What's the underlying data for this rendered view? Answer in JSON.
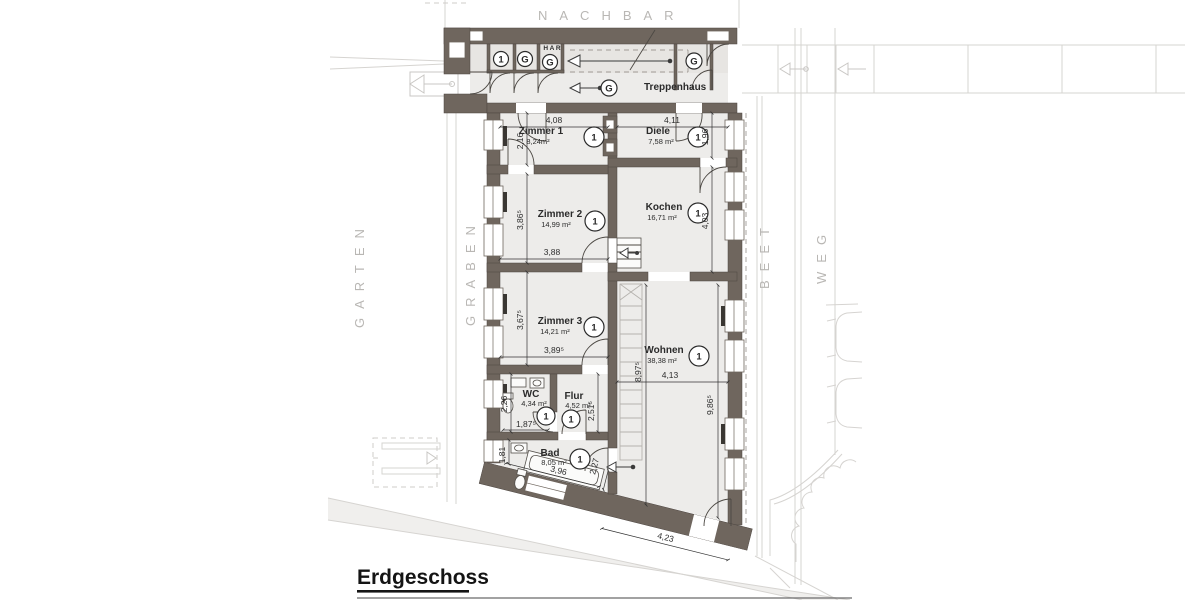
{
  "title": {
    "floor_label": "Erdgeschoss"
  },
  "surroundings": {
    "top": "NACHBAR",
    "left_outer": "GARTEN",
    "left_inner": "GRABEN",
    "right_inner": "BEET",
    "right_outer": "WEG"
  },
  "stairwell": {
    "label": "Treppenhaus",
    "har_label": "H A R",
    "unit_marker": "1",
    "storage_marker": "G"
  },
  "rooms": [
    {
      "name": "Zimmer 1",
      "area": "8,24m²",
      "marker": "1"
    },
    {
      "name": "Diele",
      "area": "7,58 m²",
      "marker": "1"
    },
    {
      "name": "Zimmer 2",
      "area": "14,99 m²",
      "marker": "1"
    },
    {
      "name": "Kochen",
      "area": "16,71 m²",
      "marker": "1"
    },
    {
      "name": "Zimmer 3",
      "area": "14,21 m²",
      "marker": "1"
    },
    {
      "name": "Wohnen",
      "area": "38,38 m²",
      "marker": "1"
    },
    {
      "name": "WC",
      "area": "4,34 m²",
      "marker": "1"
    },
    {
      "name": "Flur",
      "area": "4,52 m²",
      "marker": "1"
    },
    {
      "name": "Bad",
      "area": "8,05 m²",
      "marker": "1"
    }
  ],
  "dims": {
    "z1_w": "4,08",
    "z1_d": "2,16",
    "diele_w": "4,11",
    "diele_d": "1,96",
    "z2_d": "3,86⁵",
    "z2_w": "3,88",
    "kochen_d": "4,03",
    "z3_d": "3,67⁵",
    "z3_w": "3,89⁵",
    "wohnen_d_left": "8,97⁵",
    "wohnen_w": "4,13",
    "wohnen_d_right": "9,86⁵",
    "wohnen_bottom": "4,23",
    "wc_d": "2,26",
    "wc_w": "1,87⁵",
    "flur_d": "2,51⁵",
    "bad_d": "1,81",
    "bad_w": "3,96",
    "bad_door": "2,27"
  }
}
